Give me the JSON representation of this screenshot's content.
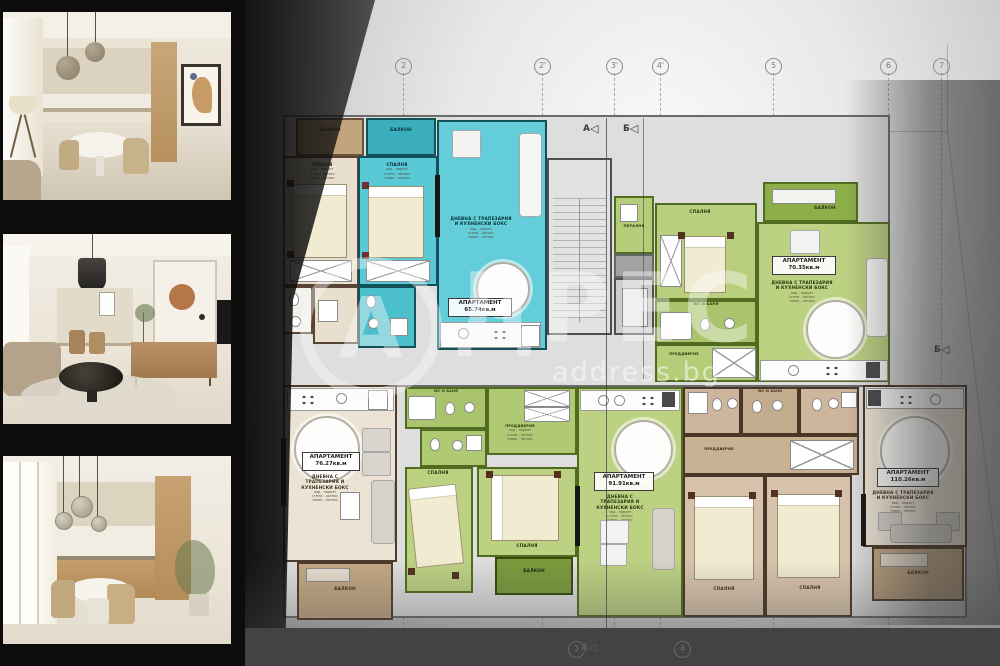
{
  "brand": {
    "logo_letter": "А",
    "wordmark": "ДРЕС",
    "domain": "address.bg"
  },
  "plan": {
    "axes_top": [
      "2",
      "2'",
      "3'",
      "4'",
      "5",
      "6",
      "7"
    ],
    "axes_bottom": [
      "3",
      "4"
    ],
    "markers": {
      "top_a": "А",
      "top_b": "Б",
      "right_b": "Б",
      "bottom_a": "А"
    },
    "finish_note": "под - паркет\nстени - латекс\nтаван - латекс",
    "rooms": {
      "bedroom": "СПАЛНЯ",
      "balcony": "БАЛКОН",
      "living": "ДНЕВНА С ТРАПЕЗАРИЯ И КУХНЕНСКИ БОКС",
      "entry": "ПРЕДДВЕРИЕ",
      "bath": "WC И БАНЯ",
      "laundry": "ПЕРАЛНЯ"
    },
    "apartments": [
      {
        "title": "АПАРТАМЕНТ",
        "area": "65.74кв.м"
      },
      {
        "title": "АПАРТАМЕНТ",
        "area": "70.35кв.м"
      },
      {
        "title": "АПАРТАМЕНТ",
        "area": "76.27кв.м"
      },
      {
        "title": "АПАРТАМЕНТ",
        "area": "91.91кв.м"
      },
      {
        "title": "АПАРТАМЕНТ",
        "area": "110.26кв.м"
      }
    ]
  }
}
